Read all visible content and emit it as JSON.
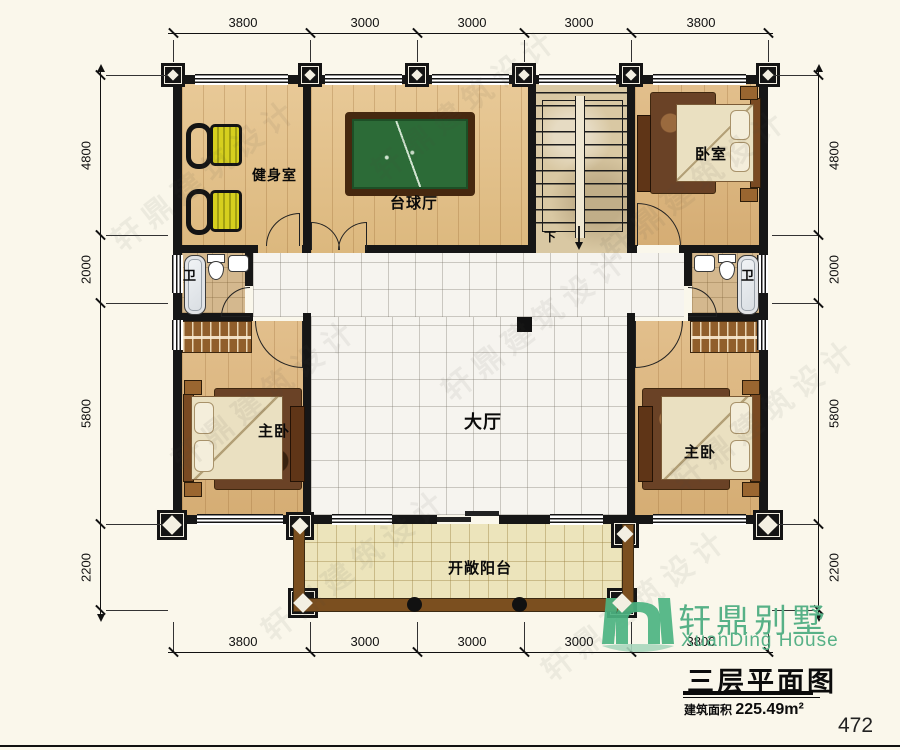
{
  "watermark": "轩鼎建筑设计",
  "rooms": {
    "gym": "健身室",
    "billiards": "台球厅",
    "bedroom": "卧室",
    "bath_left": "卫",
    "bath_right": "卫",
    "hall": "大厅",
    "master_left": "主卧",
    "master_right": "主卧",
    "balcony": "开敞阳台",
    "stairs_down": "下"
  },
  "dimensions": {
    "top": [
      "3800",
      "3000",
      "3000",
      "3000",
      "3800"
    ],
    "bottom": [
      "3800",
      "3000",
      "3000",
      "3000",
      "3800"
    ],
    "left": [
      "4800",
      "2000",
      "5800",
      "2200"
    ],
    "right": [
      "4800",
      "2000",
      "5800",
      "2200"
    ]
  },
  "title_block": {
    "brand_cn": "轩鼎别墅",
    "brand_en": "XuanDing House",
    "plan_title": "三层平面图",
    "area_label": "建筑面积",
    "area_value": "225.49m²"
  },
  "page_number": "472",
  "colors": {
    "logo_green": "#57b187",
    "wall_black": "#161616",
    "wood_floor": "#e4c38f",
    "hall_tile": "#f6f4ef",
    "balcony_floor": "#ece4bb",
    "billiard_green": "#2c6b37",
    "bike_yellow": "#d6cf1e"
  }
}
